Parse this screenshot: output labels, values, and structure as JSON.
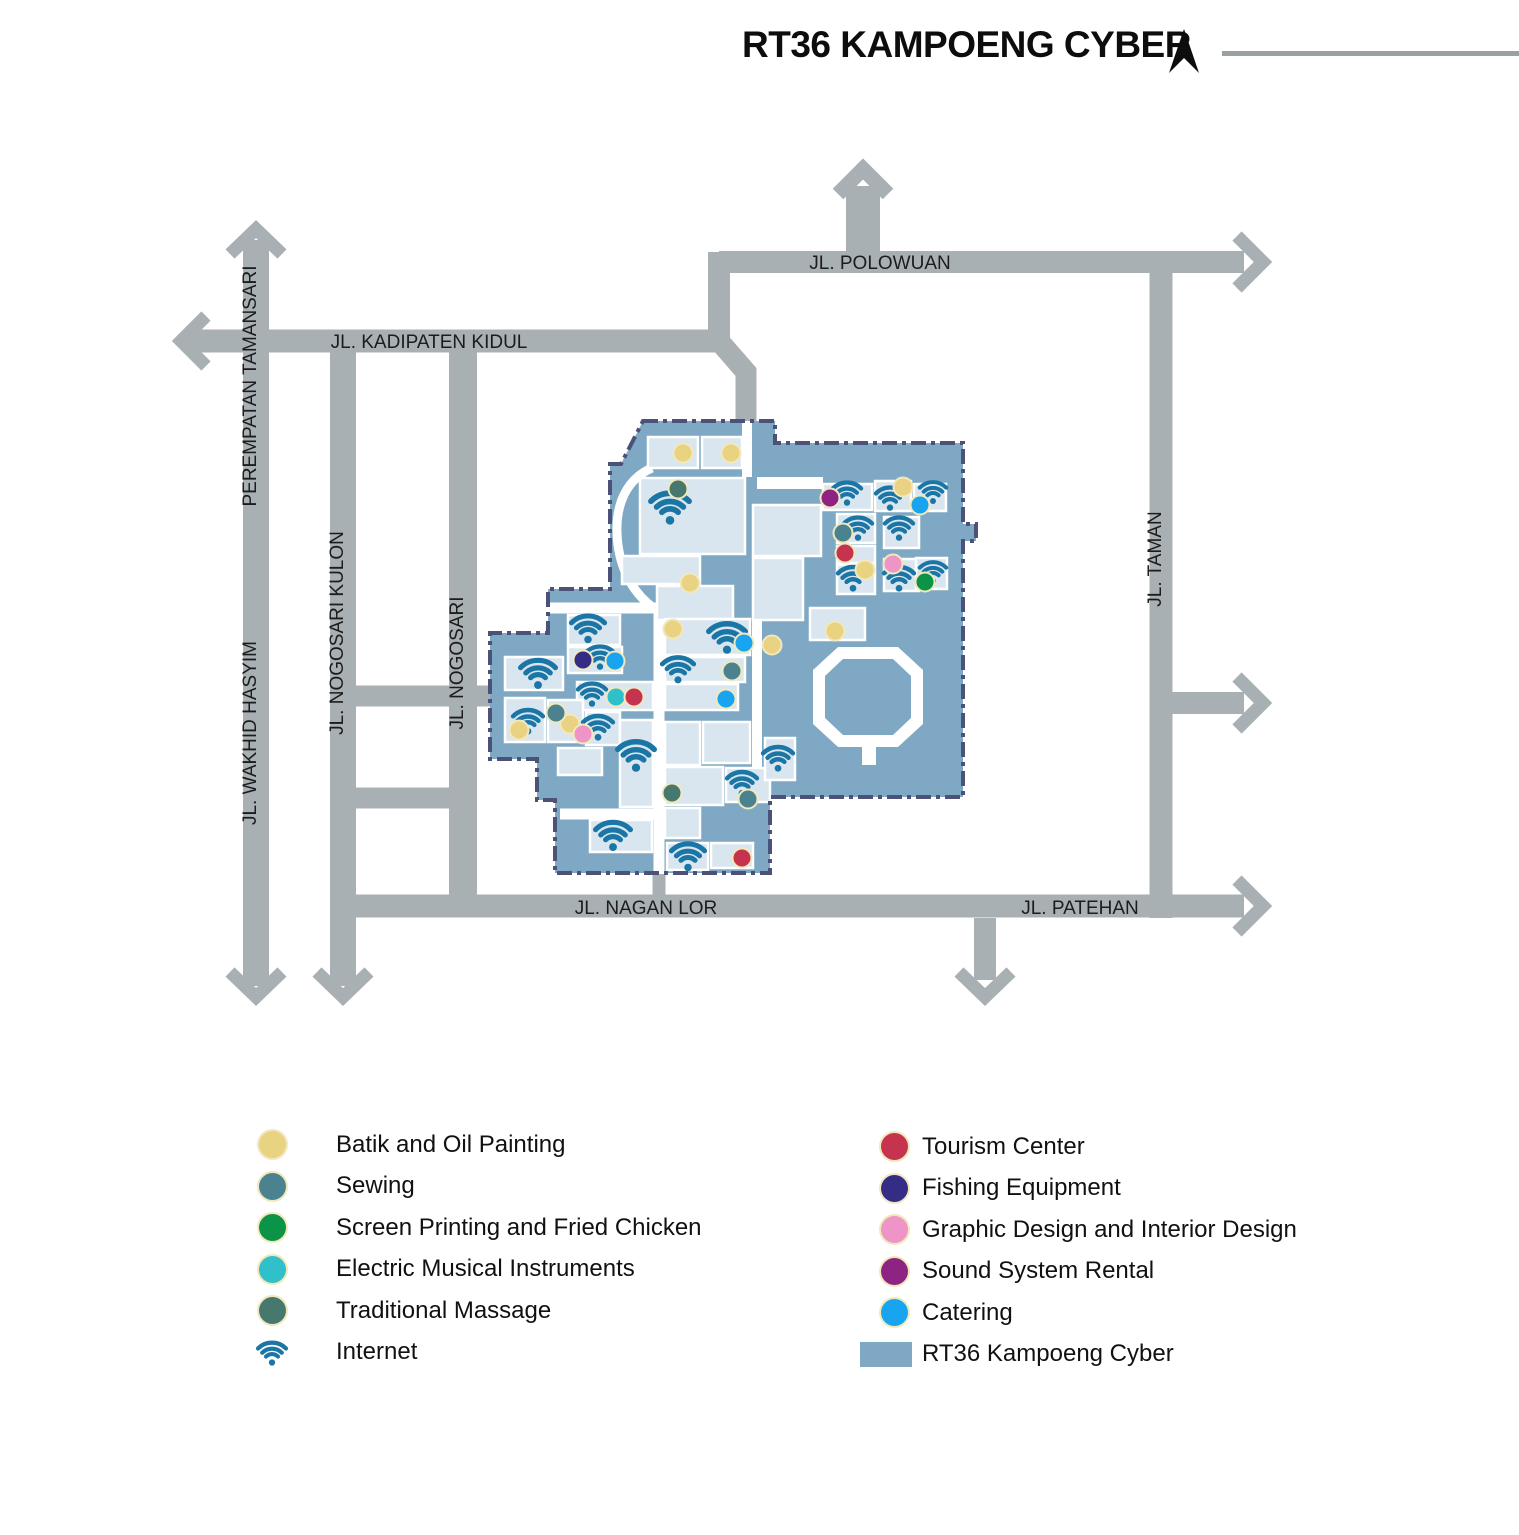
{
  "header": {
    "title": "RT36 KAMPOENG CYBER"
  },
  "streets": {
    "polowuan": "JL. POLOWUAN",
    "kadipaten": "JL. KADIPATEN KIDUL",
    "tamansari": "PEREMPATAN TAMANSARI",
    "wakhid": "JL. WAKHID HASYIM",
    "nogosari_kulon": "JL. NOGOSARI KULON",
    "nogosari": "JL. NOGOSARI",
    "taman": "JL. TAMAN",
    "nagan_lor": "JL. NAGAN LOR",
    "patehan": "JL. PATEHAN"
  },
  "colors": {
    "road": "#a9b0b4",
    "area": "#7ea8c3",
    "building": "#d9e6ef",
    "border": "#4b5177",
    "batik": "#ead283",
    "sewing": "#4a838f",
    "screen": "#0b9447",
    "electric": "#2fc0c9",
    "massage": "#46786f",
    "internet": "#1b76a5",
    "tourism": "#c5334e",
    "fishing": "#352d85",
    "graphic": "#ef94c6",
    "sound": "#8f2384",
    "catering": "#18a4ee"
  },
  "legend": {
    "left": [
      {
        "icon": "dot",
        "color": "batik",
        "label": "Batik and Oil Painting"
      },
      {
        "icon": "dot",
        "color": "sewing",
        "label": "Sewing"
      },
      {
        "icon": "dot",
        "color": "screen",
        "label": "Screen Printing and Fried Chicken"
      },
      {
        "icon": "dot",
        "color": "electric",
        "label": "Electric Musical Instruments"
      },
      {
        "icon": "dot",
        "color": "massage",
        "label": "Traditional Massage"
      },
      {
        "icon": "wifi",
        "color": "internet",
        "label": "Internet"
      }
    ],
    "right": [
      {
        "icon": "dot",
        "color": "tourism",
        "label": "Tourism Center"
      },
      {
        "icon": "dot",
        "color": "fishing",
        "label": "Fishing Equipment"
      },
      {
        "icon": "dot",
        "color": "graphic",
        "label": "Graphic Design and Interior Design"
      },
      {
        "icon": "dot",
        "color": "sound",
        "label": "Sound System Rental"
      },
      {
        "icon": "dot",
        "color": "catering",
        "label": "Catering"
      },
      {
        "icon": "swatch",
        "color": "area",
        "label": "RT36 Kampoeng Cyber"
      }
    ]
  },
  "map": {
    "buildings": [
      [
        648,
        437,
        50,
        31
      ],
      [
        702,
        437,
        40,
        31
      ],
      [
        640,
        478,
        105,
        76
      ],
      [
        622,
        556,
        78,
        28
      ],
      [
        657,
        586,
        76,
        34
      ],
      [
        823,
        484,
        49,
        26
      ],
      [
        875,
        481,
        36,
        30
      ],
      [
        914,
        484,
        32,
        27
      ],
      [
        837,
        514,
        38,
        29
      ],
      [
        884,
        517,
        35,
        31
      ],
      [
        837,
        546,
        38,
        17
      ],
      [
        837,
        565,
        38,
        29
      ],
      [
        884,
        559,
        35,
        32
      ],
      [
        916,
        558,
        31,
        31
      ],
      [
        753,
        505,
        68,
        51
      ],
      [
        753,
        558,
        50,
        62
      ],
      [
        810,
        608,
        55,
        32
      ],
      [
        665,
        619,
        85,
        36
      ],
      [
        665,
        657,
        80,
        25
      ],
      [
        665,
        684,
        73,
        26
      ],
      [
        665,
        722,
        35,
        43
      ],
      [
        703,
        722,
        47,
        41
      ],
      [
        665,
        767,
        58,
        38
      ],
      [
        726,
        768,
        44,
        34
      ],
      [
        665,
        808,
        35,
        30
      ],
      [
        667,
        843,
        41,
        27
      ],
      [
        711,
        843,
        42,
        25
      ],
      [
        568,
        615,
        52,
        30
      ],
      [
        568,
        647,
        54,
        26
      ],
      [
        505,
        657,
        58,
        33
      ],
      [
        577,
        682,
        76,
        28
      ],
      [
        505,
        698,
        40,
        44
      ],
      [
        548,
        700,
        35,
        42
      ],
      [
        586,
        712,
        34,
        33
      ],
      [
        558,
        748,
        44,
        27
      ],
      [
        620,
        720,
        33,
        87
      ],
      [
        590,
        820,
        62,
        32
      ],
      [
        765,
        738,
        30,
        42
      ]
    ],
    "wifi": [
      [
        670,
        506,
        46
      ],
      [
        847,
        492,
        34
      ],
      [
        890,
        497,
        34
      ],
      [
        933,
        491,
        32
      ],
      [
        858,
        527,
        34
      ],
      [
        899,
        527,
        34
      ],
      [
        853,
        577,
        36
      ],
      [
        899,
        577,
        36
      ],
      [
        933,
        571,
        32
      ],
      [
        588,
        627,
        40
      ],
      [
        600,
        656,
        34
      ],
      [
        538,
        672,
        42
      ],
      [
        592,
        693,
        34
      ],
      [
        528,
        720,
        36
      ],
      [
        598,
        726,
        36
      ],
      [
        636,
        754,
        44
      ],
      [
        613,
        834,
        42
      ],
      [
        727,
        636,
        44
      ],
      [
        678,
        668,
        38
      ],
      [
        742,
        782,
        36
      ],
      [
        778,
        757,
        36
      ],
      [
        688,
        855,
        40
      ]
    ],
    "dots": {
      "batik": [
        [
          683,
          453
        ],
        [
          731,
          453
        ],
        [
          690,
          583
        ],
        [
          903,
          487
        ],
        [
          865,
          570
        ],
        [
          835,
          631
        ],
        [
          772,
          645
        ],
        [
          673,
          629
        ],
        [
          570,
          724
        ],
        [
          519,
          730
        ]
      ],
      "sewing": [
        [
          843,
          533
        ],
        [
          732,
          671
        ],
        [
          556,
          713
        ],
        [
          748,
          799
        ]
      ],
      "screen": [
        [
          925,
          582
        ]
      ],
      "electric": [
        [
          616,
          697
        ]
      ],
      "massage": [
        [
          678,
          489
        ],
        [
          672,
          793
        ]
      ],
      "tourism": [
        [
          845,
          553
        ],
        [
          634,
          697
        ],
        [
          742,
          858
        ]
      ],
      "fishing": [
        [
          583,
          660
        ]
      ],
      "graphic": [
        [
          893,
          564
        ],
        [
          583,
          734
        ]
      ],
      "sound": [
        [
          830,
          498
        ]
      ],
      "catering": [
        [
          920,
          505
        ],
        [
          744,
          643
        ],
        [
          726,
          699
        ],
        [
          615,
          661
        ]
      ]
    }
  }
}
